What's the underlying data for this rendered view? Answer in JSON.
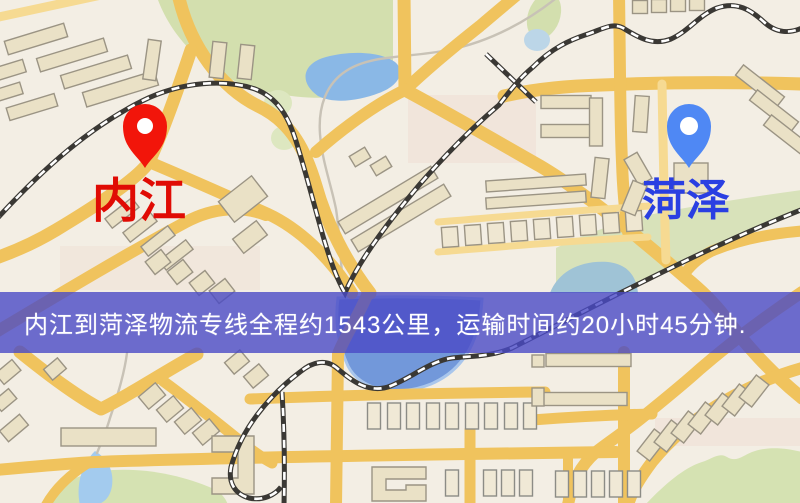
{
  "banner": {
    "text": "内江到菏泽物流专线全程约1543公里，运输时间约20小时45分钟.",
    "distance_km": "1543",
    "duration": "20小时45分钟",
    "background": "#4a4ac6",
    "text_color": "#ffffff"
  },
  "origin_label": {
    "text": "内江",
    "color": "#e00b04"
  },
  "destination_label": {
    "text": "菏泽",
    "color": "#2a3fe2"
  },
  "origin_marker": {
    "shape": "map-pin",
    "color": "#f2150a"
  },
  "destination_marker": {
    "shape": "map-pin",
    "color": "#4f88f4"
  },
  "map_palette": {
    "background": "#f3eee4",
    "road_major": "#f0c35d",
    "road_minor": "#f6da92",
    "railway": "#3a3834",
    "railway_dash": "#ffffff",
    "water": "#8ab8e6",
    "water_deep": "#7298da",
    "park": "#d3dfae",
    "building_fill": "#eae1c6",
    "building_stroke": "#9b9484"
  }
}
